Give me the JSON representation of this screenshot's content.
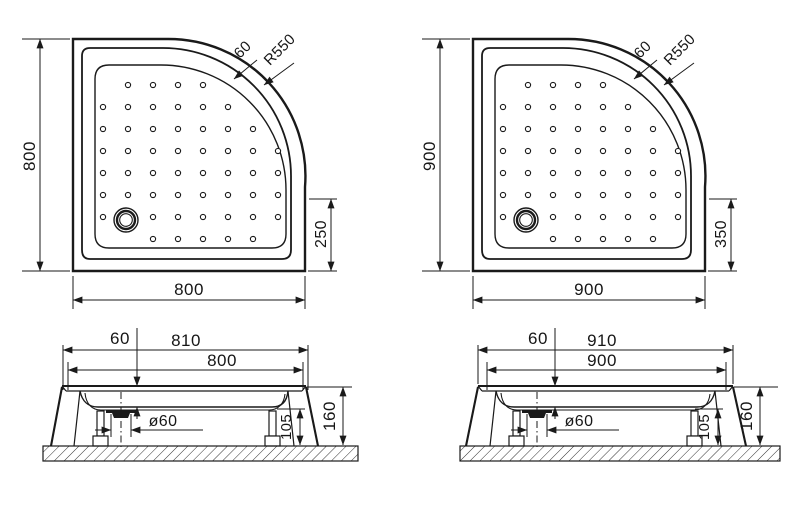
{
  "colors": {
    "background": "#ffffff",
    "line": "#1a1a1a",
    "text": "#161616"
  },
  "views": {
    "plan_800": {
      "side": "800",
      "bottom": "800",
      "rim_width": "60",
      "corner_radius": "R550",
      "drain_offset": "250"
    },
    "plan_900": {
      "side": "900",
      "bottom": "900",
      "rim_width": "60",
      "corner_radius": "R550",
      "drain_offset": "350"
    },
    "section_800": {
      "depth": "60",
      "overall_width": "810",
      "tray_width": "800",
      "drain_diameter": "ø60",
      "leg_height": "105",
      "total_height": "160"
    },
    "section_900": {
      "depth": "60",
      "overall_width": "910",
      "tray_width": "900",
      "drain_diameter": "ø60",
      "leg_height": "105",
      "total_height": "160"
    }
  },
  "dot_pattern": {
    "radius": 2.6,
    "rows": [
      {
        "y": 46,
        "cols": [
          55,
          80,
          105,
          130
        ]
      },
      {
        "y": 68,
        "cols": [
          30,
          55,
          80,
          105,
          130,
          155
        ]
      },
      {
        "y": 90,
        "cols": [
          30,
          55,
          80,
          105,
          130,
          155,
          180
        ]
      },
      {
        "y": 112,
        "cols": [
          30,
          55,
          80,
          105,
          130,
          155,
          180,
          205
        ]
      },
      {
        "y": 134,
        "cols": [
          30,
          55,
          80,
          105,
          130,
          155,
          180,
          205
        ]
      },
      {
        "y": 156,
        "cols": [
          30,
          55,
          80,
          105,
          130,
          155,
          180,
          205
        ]
      },
      {
        "y": 178,
        "cols": [
          30,
          80,
          105,
          130,
          155,
          180,
          205
        ]
      },
      {
        "y": 200,
        "cols": [
          80,
          105,
          130,
          155,
          180
        ]
      }
    ]
  }
}
